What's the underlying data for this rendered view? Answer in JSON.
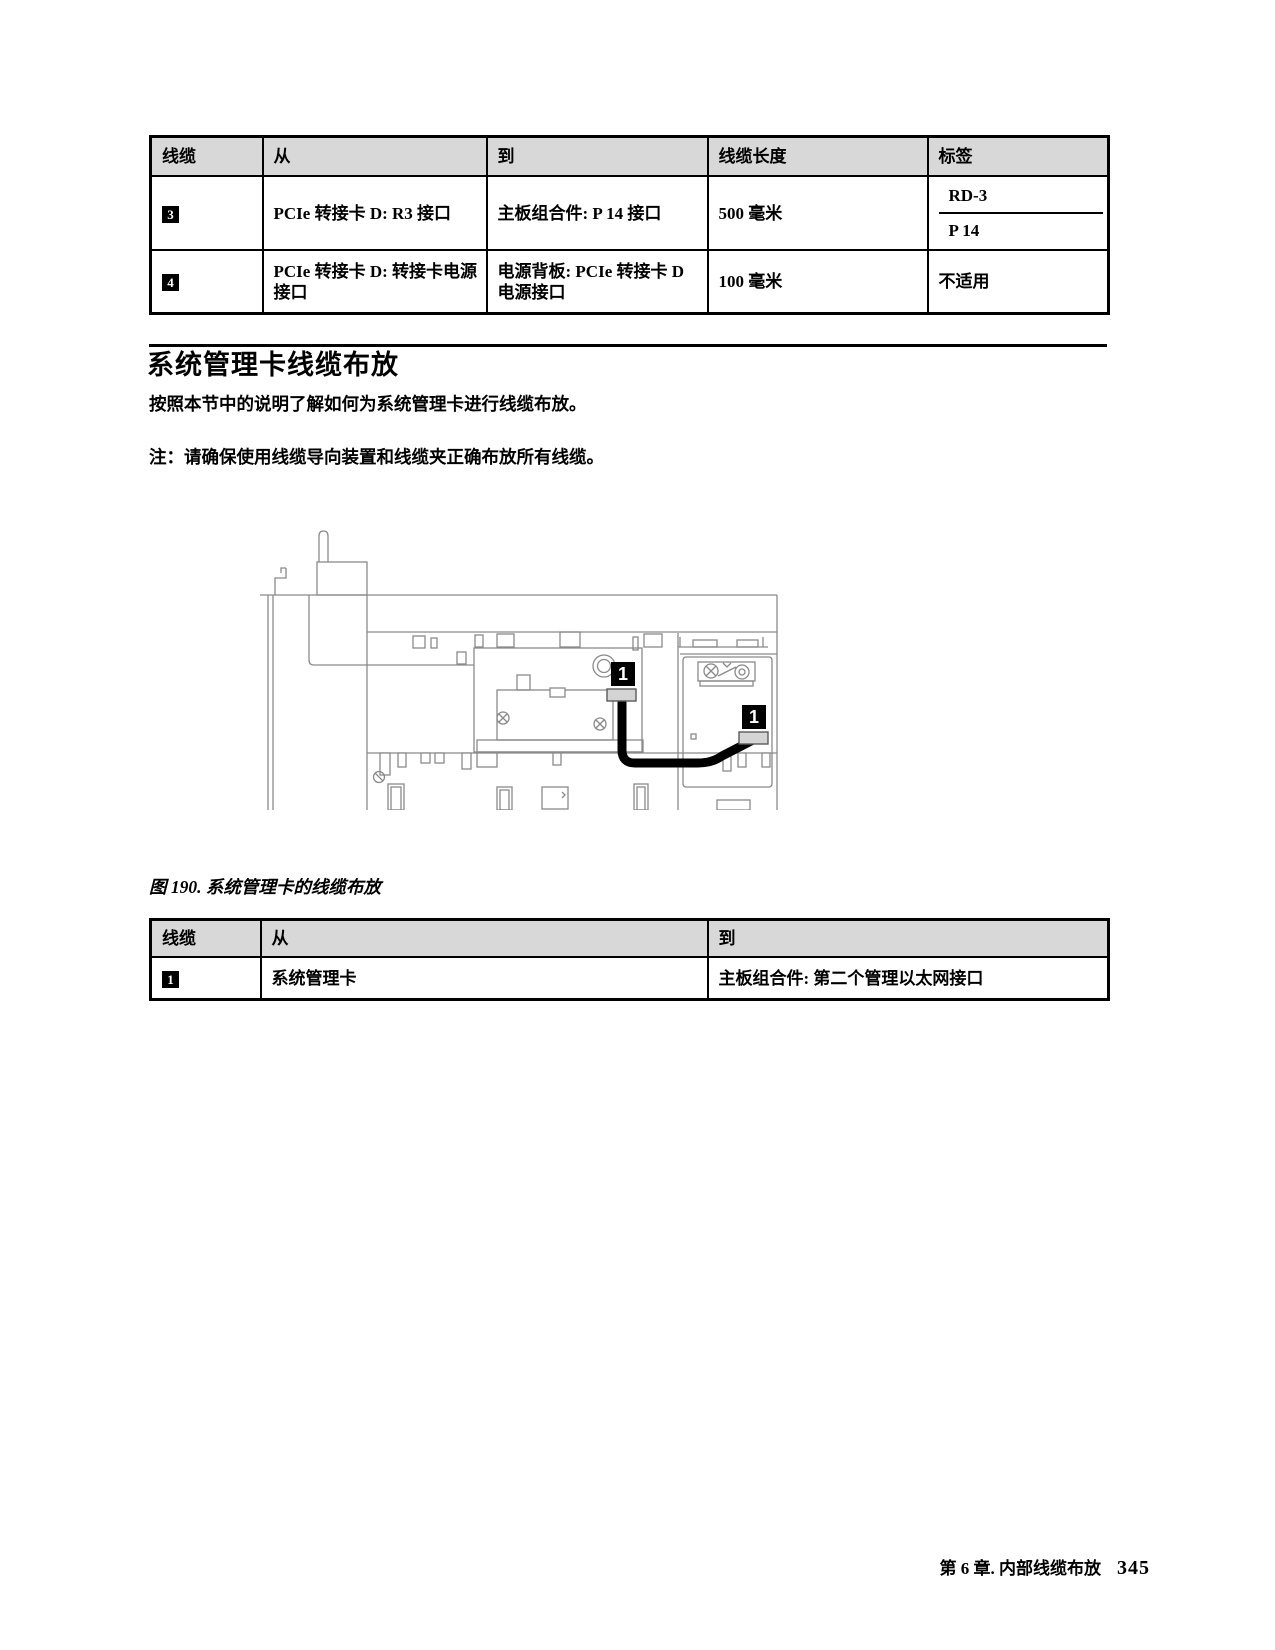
{
  "table1": {
    "headers": [
      "线缆",
      "从",
      "到",
      "线缆长度",
      "标签"
    ],
    "rows": [
      {
        "badge": "3",
        "from": "PCIe 转接卡 D: R3 接口",
        "to": "主板组合件: P 14 接口",
        "length": "500 毫米",
        "labels": [
          "RD-3",
          "P 14"
        ]
      },
      {
        "badge": "4",
        "from": "PCIe 转接卡 D: 转接卡电源接口",
        "to": "电源背板: PCIe 转接卡 D 电源接口",
        "length": "100 毫米",
        "labels": [
          "不适用"
        ]
      }
    ]
  },
  "section": {
    "title": "系统管理卡线缆布放",
    "intro": "按照本节中的说明了解如何为系统管理卡进行线缆布放。",
    "note": "注：请确保使用线缆导向装置和线缆夹正确布放所有线缆。"
  },
  "figure": {
    "caption": "图 190. 系统管理卡的线缆布放",
    "callouts": [
      "1",
      "1"
    ]
  },
  "table2": {
    "headers": [
      "线缆",
      "从",
      "到"
    ],
    "rows": [
      {
        "badge": "1",
        "from": "系统管理卡",
        "to": "主板组合件: 第二个管理以太网接口"
      }
    ]
  },
  "footer": {
    "chapter": "第 6 章. 内部线缆布放",
    "page_number": "345"
  },
  "colors": {
    "table_header_bg": "#d8d8d8",
    "diagram_line": "#8a8a8a",
    "connector_fill": "#d4d4d4",
    "cable": "#000000"
  }
}
